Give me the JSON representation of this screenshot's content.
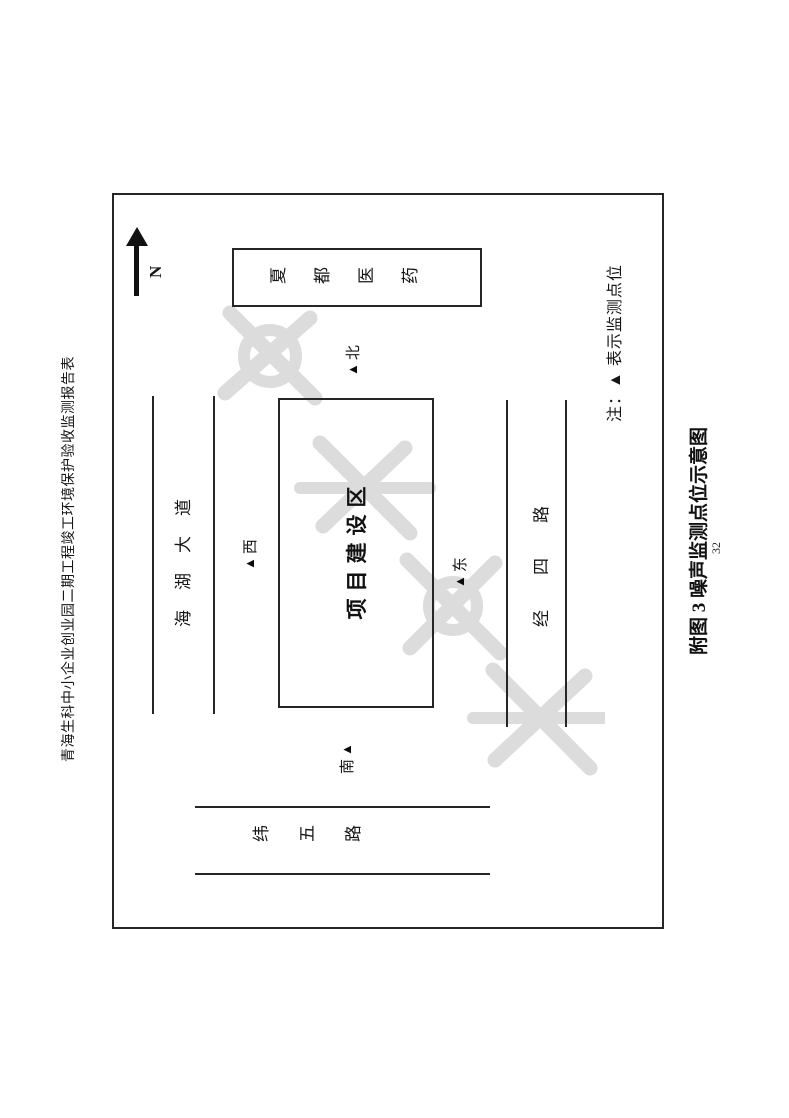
{
  "page": {
    "header_title": "青海生科中小企业创业园二期工程竣工环境保护验收监测报告表",
    "caption": "附图 3  噪声监测点位示意图",
    "page_number": "32"
  },
  "compass": {
    "label": "N"
  },
  "diagram": {
    "project_area": {
      "label": "项目建设区"
    },
    "neighbor_building": {
      "label": "夏都医药"
    },
    "roads": {
      "top": {
        "name": "海湖大道"
      },
      "bottom": {
        "name": "经四路"
      },
      "left": {
        "name": "纬五路"
      }
    },
    "monitor_points": [
      {
        "id": "north",
        "marker": "▲",
        "label": "北"
      },
      {
        "id": "west",
        "marker": "▲",
        "label": "西"
      },
      {
        "id": "east",
        "marker": "▲",
        "label": "东"
      },
      {
        "id": "south",
        "marker": "▲",
        "label": "南"
      }
    ],
    "legend_note": "注：▲ 表示监测点位"
  },
  "colors": {
    "line": "#262626",
    "text": "#161616",
    "watermark": "#dcdcdc"
  }
}
